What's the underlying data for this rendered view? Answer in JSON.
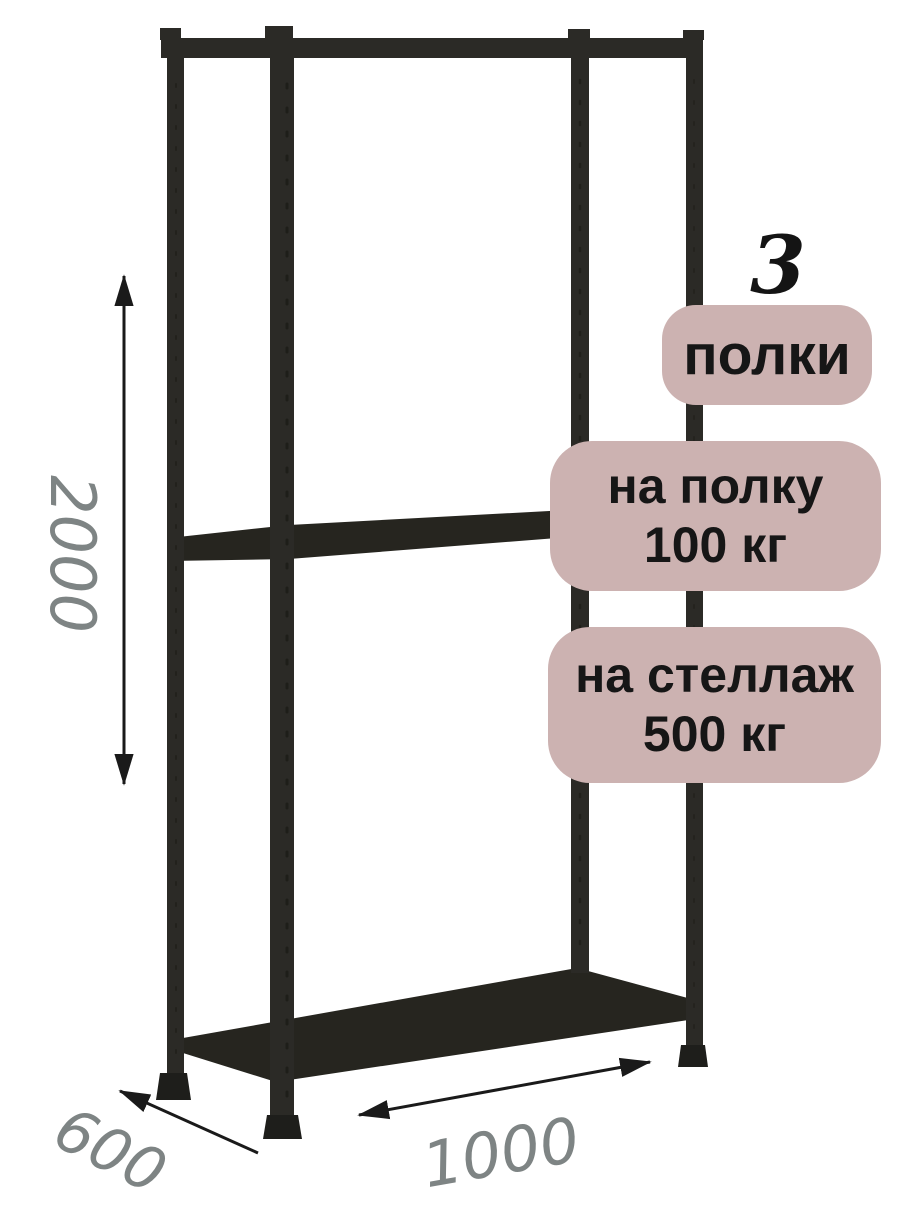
{
  "badges": {
    "count_number": "3",
    "count": {
      "label": "полки"
    },
    "per_shelf": {
      "line1": "на полку",
      "line2": "100 кг"
    },
    "per_rack": {
      "line1": "на стеллаж",
      "line2": "500 кг"
    }
  },
  "dimensions": {
    "height": "2000",
    "depth": "600",
    "width": "1000"
  },
  "colors": {
    "frame": "#2b2a26",
    "shelf": "#26251f",
    "feet": "#1e1e1b",
    "badge_bg": "#ccb2b1",
    "badge_text": "#161616",
    "dim_text": "#7e8484",
    "arrow": "#1a1a1a"
  }
}
